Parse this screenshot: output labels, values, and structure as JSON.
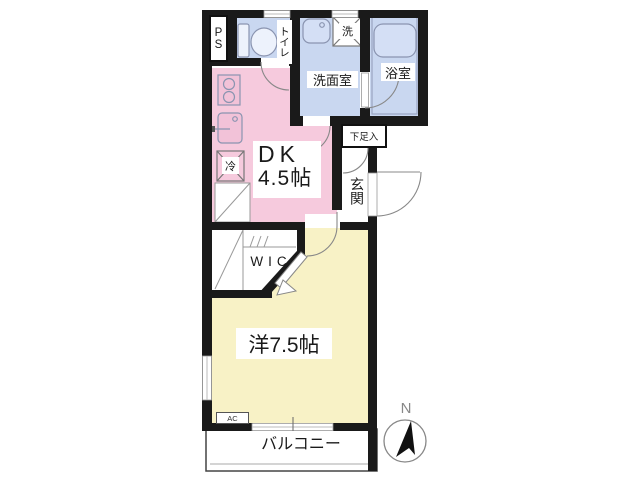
{
  "floorplan": {
    "rooms": {
      "ps": "PS",
      "toilet": "トイレ",
      "washer": "洗",
      "washroom": "洗面室",
      "bathroom": "浴室",
      "dk_name": "DK",
      "dk_size": "4.5帖",
      "fridge": "冷",
      "shoe_cabinet": "下足入",
      "entrance": "玄関",
      "wic": "WIC",
      "western_room": "洋7.5帖",
      "ac_unit": "AC",
      "balcony": "バルコニー"
    },
    "compass": {
      "north": "N"
    },
    "colors": {
      "wall": "#1a1a1a",
      "dk": "#f6cadd",
      "wet_area": "#c9d7f0",
      "western_room": "#f8f2c6",
      "fixture_outline": "#8a94b0"
    }
  }
}
